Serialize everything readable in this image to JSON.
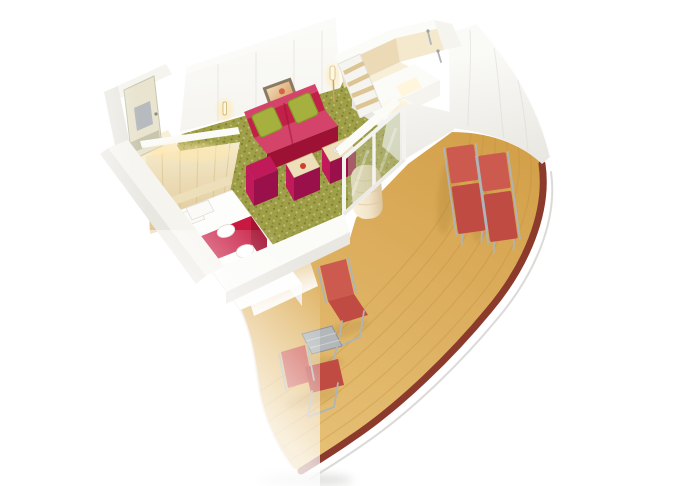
{
  "colors": {
    "background": "#ffffff",
    "wall_white": "#f5f4ef",
    "wall_top_white": "#fbfbf8",
    "wall_shadow": "#e9e7e1",
    "wall_seam": "#d9d7d0",
    "tile_beige": "#ecd9b6",
    "tile_beige_light": "#f4e8cd",
    "bath_floor": "#f8efd8",
    "door_cream": "#e8e4cf",
    "door_frame": "#c9c6ae",
    "mirror_gray": "#b7babe",
    "wood_light": "#eedfbb",
    "wood_dark": "#dcc493",
    "wood_grain": "#cfb37f",
    "carpet_olive": "#9f9f48",
    "carpet_dark": "#7d7d2f",
    "carpet_light": "#c3c382",
    "sofa_red": "#c22048",
    "sofa_red_dark": "#9c1134",
    "sofa_red_light": "#d4436a",
    "pillow_green": "#a6b03e",
    "pillow_green_dark": "#879727",
    "ottoman_magenta": "#c01a5a",
    "ottoman_magenta_dark": "#99104a",
    "runner_red": "#c81940",
    "runner_red_dark": "#a51232",
    "bed_white": "#fdfdfb",
    "bed_side": "#ecebe6",
    "deck_gold": "#d4a14b",
    "deck_gold_light": "#e7c178",
    "deck_plank": "#bb8c3a",
    "railing_red_brown": "#8c3a2c",
    "hull_seam": "#d8d6d1",
    "lounger_red": "#cd5a4f",
    "lounger_red_dark": "#c04b42",
    "metal_gray": "#afb4b7",
    "glass_tint": "#b9bc8e",
    "curtain_beige": "#f2e4c8",
    "curtain_fold": "#dcc49e",
    "glow_warm": "#ffe7ab",
    "art_frame": "#8b7a63",
    "art_orange": "#dda06a",
    "fruit_red": "#cf3f2a",
    "shadow_olive": "#55551e",
    "shadow_warm": "#7a5a18"
  },
  "objects": {
    "plan": "Cabin 3D floor plan",
    "entry_door": "Entry door with mirror",
    "wardrobe": "Wardrobe",
    "bed": "Double bed",
    "runner": "Bed runner",
    "towels": "Folded towels",
    "pillows": "Pillows",
    "sofa": "Sofa",
    "cushions": "Green cushions",
    "stool": "Stool",
    "ottoman_tray": "Ottoman with tray",
    "ottoman_cup": "Ottoman with coffee cup",
    "picture": "Wall picture",
    "lamp": "Wall lamp",
    "shelf": "Shelf unit",
    "vanity": "Vanity with mirror light",
    "bathroom": "Bathroom",
    "shower": "Shower fixture",
    "carpet": "Carpet",
    "glass_door": "Sliding glass door",
    "curtain": "Curtain",
    "deck": "Balcony deck",
    "railing": "Balcony railing",
    "lounger": "Sun lounger",
    "chair": "Folding deck chair",
    "table": "Balcony table",
    "hull": "Ship hull"
  }
}
